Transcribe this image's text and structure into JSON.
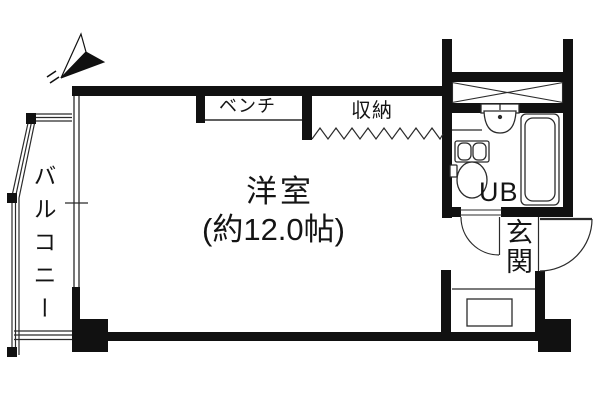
{
  "plan": {
    "labels": {
      "room": "洋室",
      "room_size": "(約12.0帖)",
      "balcony": "バルコニー",
      "bench": "ベンチ",
      "storage": "収納",
      "unit_bath": "UB",
      "entrance": "玄関"
    },
    "colors": {
      "wall": "#111111",
      "line": "#2b2b2b",
      "background": "#ffffff"
    },
    "icons": [
      "north-arrow-icon",
      "toilet-icon",
      "washbasin-icon",
      "bathtub-icon",
      "door-swing-icon",
      "shaft-cross-icon",
      "open-closet-zigzag-icon"
    ]
  }
}
